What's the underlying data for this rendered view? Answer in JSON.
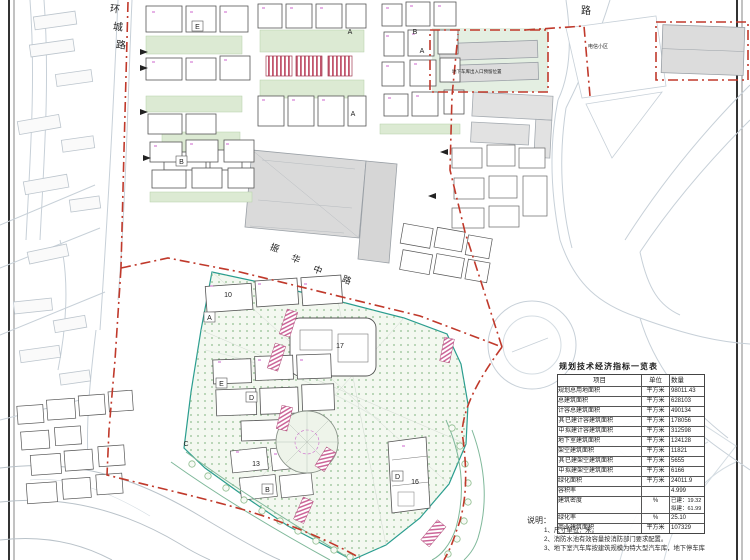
{
  "roads": {
    "ring": [
      "环",
      "城",
      "路"
    ],
    "top_right": "路",
    "mid": [
      "振",
      "华",
      "中",
      "路"
    ]
  },
  "annotations": {
    "garage": "地下车库出入口预留位置",
    "district": "电信小区"
  },
  "map_labels": {
    "e1": "E",
    "b1": "B",
    "a1": "A",
    "b2": "B",
    "a2": "A",
    "a3": "A",
    "n10": "10",
    "a4": "A",
    "n17": "17",
    "e2": "E",
    "d1": "D",
    "c1": "C",
    "n13": "13",
    "b3": "B",
    "d2": "D",
    "n16": "16"
  },
  "table": {
    "title": "规划技术经济指标一览表",
    "headers": [
      "项目",
      "单位",
      "数量"
    ],
    "rows": [
      {
        "label": "规划总用地面积",
        "unit": "平方米",
        "value": "98011.43"
      },
      {
        "label": "总建筑面积",
        "unit": "平方米",
        "value": "628103"
      },
      {
        "label": "计容总建筑面积",
        "unit": "平方米",
        "value": "490134"
      },
      {
        "group": "其",
        "label": "已建计容建筑面积",
        "unit": "平方米",
        "value": "178056"
      },
      {
        "group": "中",
        "label": "拟建计容建筑面积",
        "unit": "平方米",
        "value": "312598"
      },
      {
        "label": "地下室建筑面积",
        "unit": "平方米",
        "value": "124128"
      },
      {
        "label": "架空建筑面积",
        "unit": "平方米",
        "value": "11821"
      },
      {
        "group": "其",
        "label": "已建架空建筑面积",
        "unit": "平方米",
        "value": "5655"
      },
      {
        "group": "中",
        "label": "拟建架空建筑面积",
        "unit": "平方米",
        "value": "6166"
      },
      {
        "label": "绿化面积",
        "unit": "平方米",
        "value": "24011.9"
      },
      {
        "label": "容积率",
        "unit": "",
        "value": "4.999"
      },
      {
        "label": "建筑密度",
        "unit": "%",
        "value": "已建：19.32",
        "value2": "拟建：61.99"
      },
      {
        "label": "绿化率",
        "unit": "%",
        "value": "25.10"
      },
      {
        "label": "商业建筑面积",
        "unit": "平方米",
        "value": "107329"
      }
    ]
  },
  "notes": {
    "heading": "说明：",
    "items": [
      "1、尺寸单位：米。",
      "2、消防水池有效容量按消防部门要求配置。",
      "3、地下室汽车库按建筑规模为特大型汽车库，地下停车库"
    ]
  },
  "colors": {
    "boundary": "#c0392b",
    "park_outline": "#2a9d8f",
    "lawn": "#dcead3",
    "hatch": "#c2566e",
    "annotation_pink": "#cc66cc"
  }
}
